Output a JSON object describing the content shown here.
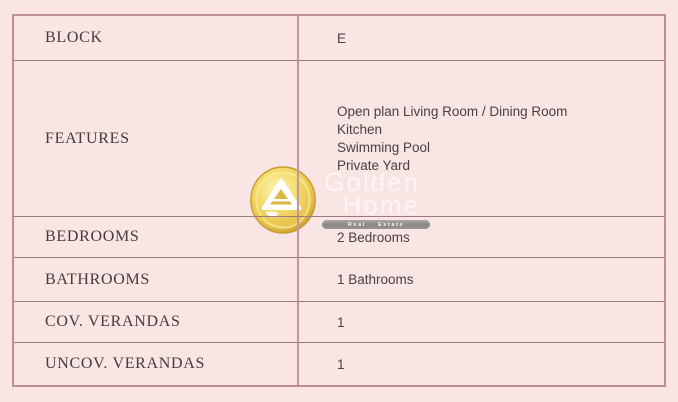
{
  "table": {
    "rows": [
      {
        "label": "BLOCK",
        "value": "E"
      },
      {
        "label": "FEATURES",
        "value_lines": [
          "Open plan Living Room / Dining Room",
          "Kitchen",
          "Swimming Pool",
          "Private Yard"
        ]
      },
      {
        "label": "BEDROOMS",
        "value": "2 Bedrooms"
      },
      {
        "label": "BATHROOMS",
        "value": "1 Bathrooms"
      },
      {
        "label": "COV. VERANDAS",
        "value": "1"
      },
      {
        "label": "UNCOV. VERANDAS",
        "value": "1"
      }
    ]
  },
  "watermark": {
    "brand_line1": "Golden",
    "brand_line2": "Home",
    "tagline": "Real Estate",
    "logo_icon": "golden-home-pyramid-logo"
  },
  "colors": {
    "page_background": "#f8e5e4",
    "outer_border": "#bf8d95",
    "row_separator": "#9d7a7e",
    "column_divider": "#c4949c",
    "label_text": "#473a3c",
    "value_text": "#494143",
    "logo_gold_dark": "#c89d2f",
    "logo_gold_mid": "#eed25e",
    "logo_gold_light": "#fdf4bb",
    "tagline_pill_gray": "#929292"
  }
}
